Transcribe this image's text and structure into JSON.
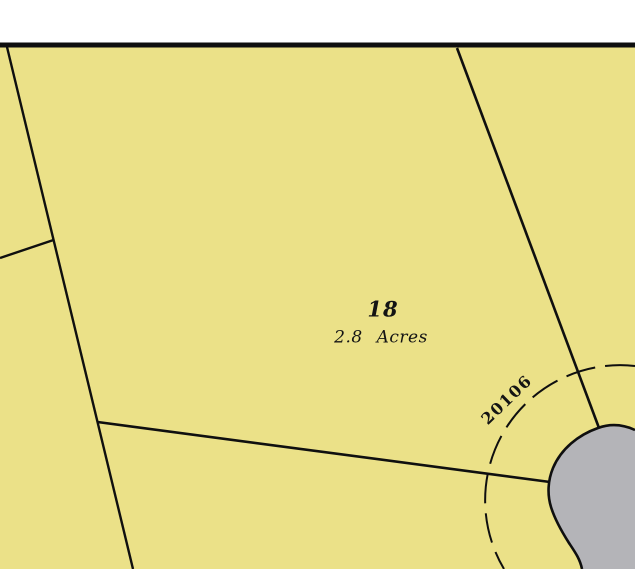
{
  "canvas": {
    "width": 635,
    "height": 569
  },
  "colors": {
    "page_background": "#ffffff",
    "parcel_fill": "#ebe188",
    "road_fill": "#b4b4b8",
    "line_color": "#0f0f0f",
    "label_color": "#141414"
  },
  "map": {
    "top_border": {
      "name": "north-border-line",
      "x": 0,
      "y": 42.5,
      "width": 635,
      "height": 5
    },
    "parcel_area": {
      "name": "parcel-fill-area",
      "x": 0,
      "y": 46,
      "width": 635,
      "height": 523
    },
    "boundary_lines": [
      {
        "name": "west-boundary-line",
        "x1": 7,
        "y1": 47,
        "x2": 133,
        "y2": 569,
        "stroke_width": 2.4
      },
      {
        "name": "west-spur-line",
        "x1": 53.5,
        "y1": 240,
        "x2": 0,
        "y2": 258,
        "stroke_width": 2.4
      },
      {
        "name": "south-boundary-line",
        "x1": 97.5,
        "y1": 422,
        "x2": 550,
        "y2": 482,
        "stroke_width": 2.6
      },
      {
        "name": "east-boundary-line",
        "x1": 457,
        "y1": 48,
        "x2": 599,
        "y2": 428,
        "stroke_width": 2.6
      }
    ],
    "culdesac": {
      "name": "culdesac-road",
      "fill_path": "M 635 430 C 622 424 609 424 598 428 C 578 435 561 449 553 468 C 548 480 547 494 551 507 C 555 520 562 532 569 543 C 575 552 580 559 582 569 L 635 569 Z",
      "edge_path": "M 635 430 C 622 424 609 424 598 428 C 578 435 561 449 553 468 C 548 480 547 494 551 507 C 555 520 562 532 569 543 C 575 552 580 559 582 569",
      "stroke_width": 2.6
    },
    "dashed_arc": {
      "name": "right-of-way-dashed-arc",
      "path": "M 635 366 A 135 135 0 0 0 504 569",
      "dasharray": "30 10",
      "stroke_width": 2
    },
    "labels": {
      "lot_number": {
        "text": "18",
        "x": 383,
        "y": 309,
        "font_size": 21,
        "rotation": 0
      },
      "lot_area": {
        "text": "2.8 Acres",
        "x": 381,
        "y": 338,
        "font_size": 17,
        "rotation": 0
      },
      "street_number": {
        "text": "20106",
        "x": 507,
        "y": 400,
        "font_size": 16,
        "rotation": -44
      }
    }
  }
}
